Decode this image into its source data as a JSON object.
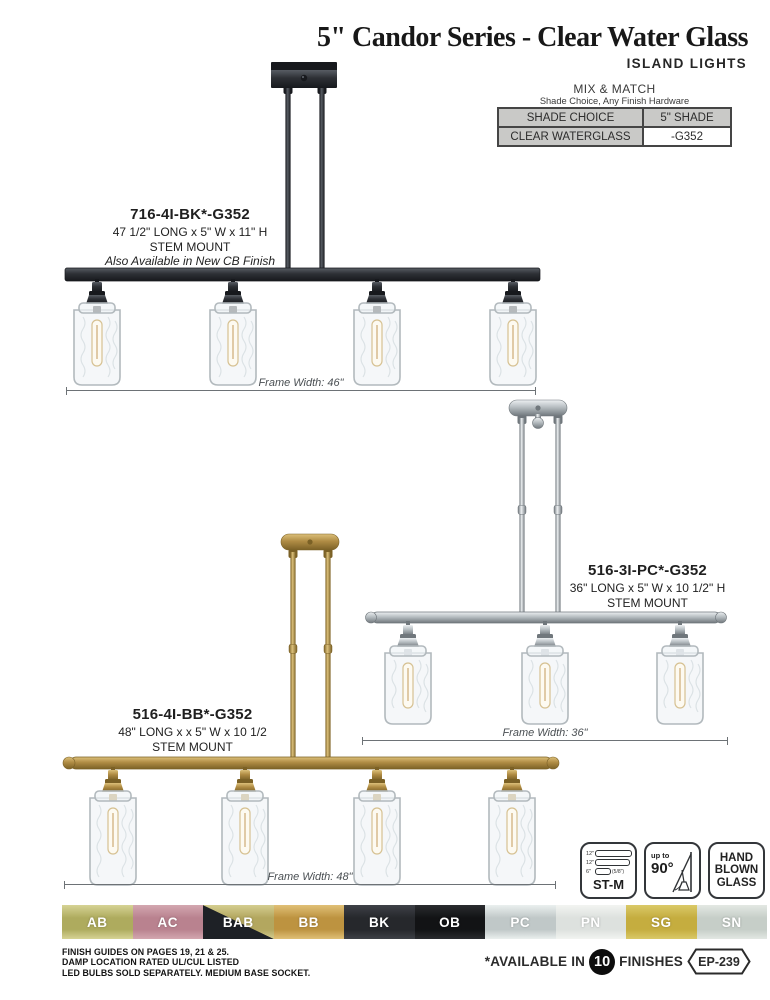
{
  "page": {
    "title": "5\" Candor Series - Clear Water Glass",
    "subtitle": "ISLAND LIGHTS",
    "page_ref": "EP-239"
  },
  "mix_match": {
    "line1": "MIX & MATCH",
    "line2": "Shade Choice, Any Finish Hardware",
    "table": {
      "header": [
        "SHADE CHOICE",
        "5\" SHADE"
      ],
      "rows": [
        [
          "CLEAR WATERGLASS",
          "-G352"
        ]
      ]
    }
  },
  "products": [
    {
      "model": "716-4I-BK*-G352",
      "dimensions": "47 1/2\" LONG x 5\" W x 11\" H",
      "mount": "STEM MOUNT",
      "note": "Also Available in New CB Finish",
      "frame_width": "Frame Width: 46\"",
      "lights": 4,
      "finish": "BK",
      "colors": {
        "main": "#2d3035",
        "dark": "#17191d",
        "light": "#585d64"
      }
    },
    {
      "model": "516-3I-PC*-G352",
      "dimensions": "36\" LONG x 5\" W x 10 1/2\" H",
      "mount": "STEM MOUNT",
      "note": "",
      "frame_width": "Frame Width: 36\"",
      "lights": 3,
      "finish": "PC",
      "colors": {
        "main": "#b6bdc1",
        "dark": "#70777c",
        "light": "#edf0f2"
      }
    },
    {
      "model": "516-4I-BB*-G352",
      "dimensions": "48\" LONG x x 5\" W x 10 1/2",
      "mount": "STEM MOUNT",
      "note": "",
      "frame_width": "Frame Width: 48\"",
      "lights": 4,
      "finish": "BB",
      "colors": {
        "main": "#b08c44",
        "dark": "#7b6126",
        "light": "#dcc07a"
      }
    }
  ],
  "icons": {
    "stem_kit": {
      "label": "ST-M",
      "rods": [
        "12\"",
        "12\"",
        "6\""
      ],
      "rod_note": "(5/8\")"
    },
    "sloped": {
      "small": "up to",
      "big": "90°"
    },
    "glass": [
      "HAND",
      "BLOWN",
      "GLASS"
    ]
  },
  "finishes": [
    {
      "code": "AB",
      "base": "#aeab5e",
      "light": "#d6d395"
    },
    {
      "code": "AC",
      "base": "#b9828f",
      "light": "#d3a7b0"
    },
    {
      "code": "BAB",
      "base": "#b3a75f",
      "light": "#d4cd90",
      "split_dark": "#1e2126"
    },
    {
      "code": "BB",
      "base": "#bd9340",
      "light": "#e0c077"
    },
    {
      "code": "BK",
      "base": "#26282c",
      "light": "#3e4147"
    },
    {
      "code": "OB",
      "base": "#121315",
      "light": "#2a2c2f"
    },
    {
      "code": "PC",
      "base": "#c0c8c8",
      "light": "#eaefee"
    },
    {
      "code": "PN",
      "base": "#dde1de",
      "light": "#f2f4f1"
    },
    {
      "code": "SG",
      "base": "#c5ad3f",
      "light": "#dac968"
    },
    {
      "code": "SN",
      "base": "#c6cec8",
      "light": "#e3e8e3"
    }
  ],
  "footer": {
    "lines": [
      "FINISH GUIDES ON PAGES 19, 21 & 25.",
      "DAMP LOCATION RATED UL/CUL LISTED",
      "LED BULBS SOLD SEPARATELY. MEDIUM BASE SOCKET."
    ],
    "available_prefix": "*AVAILABLE IN",
    "available_count": "10",
    "available_suffix": "FINISHES"
  }
}
